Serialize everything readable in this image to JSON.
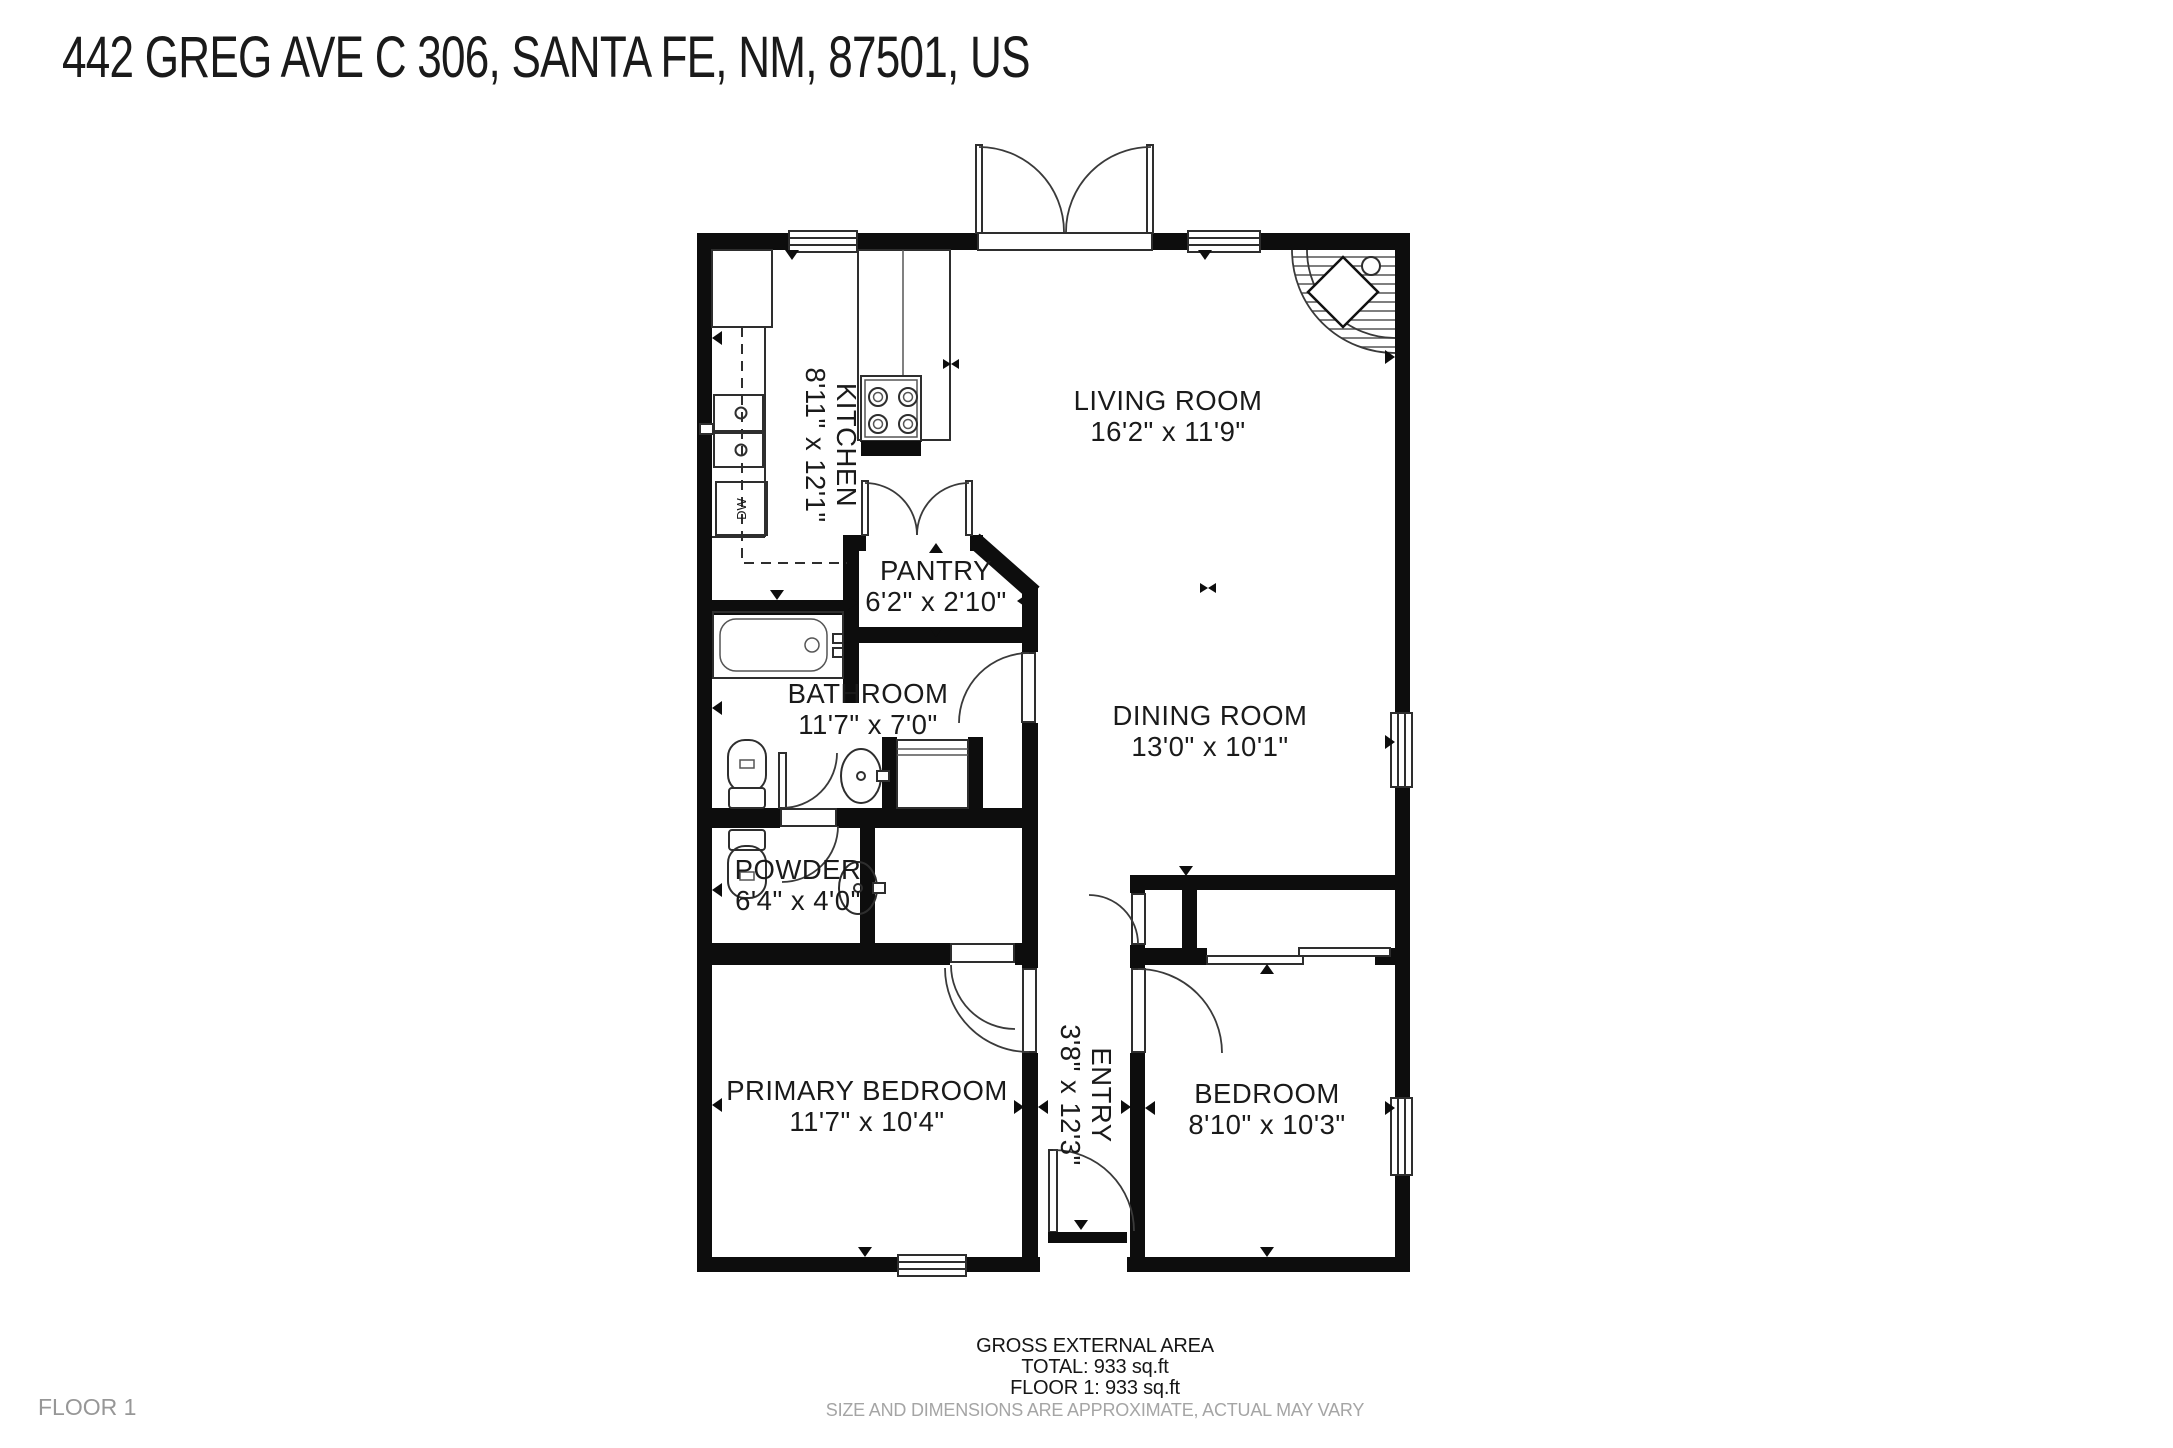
{
  "title": "442 GREG AVE C 306, SANTA FE, NM, 87501, US",
  "floor_tag": "FLOOR 1",
  "footer": {
    "area_heading": "GROSS EXTERNAL AREA",
    "total": "TOTAL: 933 sq.ft",
    "floor1": "FLOOR 1: 933 sq.ft",
    "disclaimer": "SIZE AND DIMENSIONS ARE APPROXIMATE, ACTUAL MAY VARY"
  },
  "colors": {
    "wall": "#0d0d0d",
    "fixture_line": "#2e2e2e",
    "text": "#1a1a1a",
    "muted_text": "#a5a5a5",
    "background": "#ffffff"
  },
  "floorplan": {
    "rooms": [
      {
        "name": "KITCHEN",
        "dims": "8'11\" x 12'1\"",
        "cx": 830,
        "cy": 445,
        "rotate": 90
      },
      {
        "name": "LIVING ROOM",
        "dims": "16'2\" x 11'9\"",
        "cx": 1168,
        "cy": 417,
        "rotate": 0
      },
      {
        "name": "PANTRY",
        "dims": "6'2\" x 2'10\"",
        "cx": 936,
        "cy": 587,
        "rotate": 0
      },
      {
        "name": "BATHROOM",
        "dims": "11'7\" x 7'0\"",
        "cx": 868,
        "cy": 710,
        "rotate": 0
      },
      {
        "name": "DINING ROOM",
        "dims": "13'0\" x 10'1\"",
        "cx": 1210,
        "cy": 732,
        "rotate": 0
      },
      {
        "name": "POWDER",
        "dims": "6'4\" x 4'0\"",
        "cx": 798,
        "cy": 886,
        "rotate": 0
      },
      {
        "name": "PRIMARY BEDROOM",
        "dims": "11'7\" x 10'4\"",
        "cx": 867,
        "cy": 1107,
        "rotate": 0
      },
      {
        "name": "ENTRY",
        "dims": "3'8\" x 12'3\"",
        "cx": 1085,
        "cy": 1095,
        "rotate": 90
      },
      {
        "name": "BEDROOM",
        "dims": "8'10\" x 10'3\"",
        "cx": 1267,
        "cy": 1110,
        "rotate": 0
      }
    ],
    "fixtures": {
      "dishwasher_label": "DW",
      "icons": [
        "stove-icon",
        "kitchen-sink-icon",
        "dishwasher-icon",
        "refrigerator-icon",
        "bathtub-icon",
        "toilet-icon",
        "vanity-sink-icon",
        "fireplace-icon",
        "window-icon",
        "door-swing-icon",
        "french-door-icon",
        "sliding-door-icon",
        "linen-closet"
      ]
    }
  }
}
